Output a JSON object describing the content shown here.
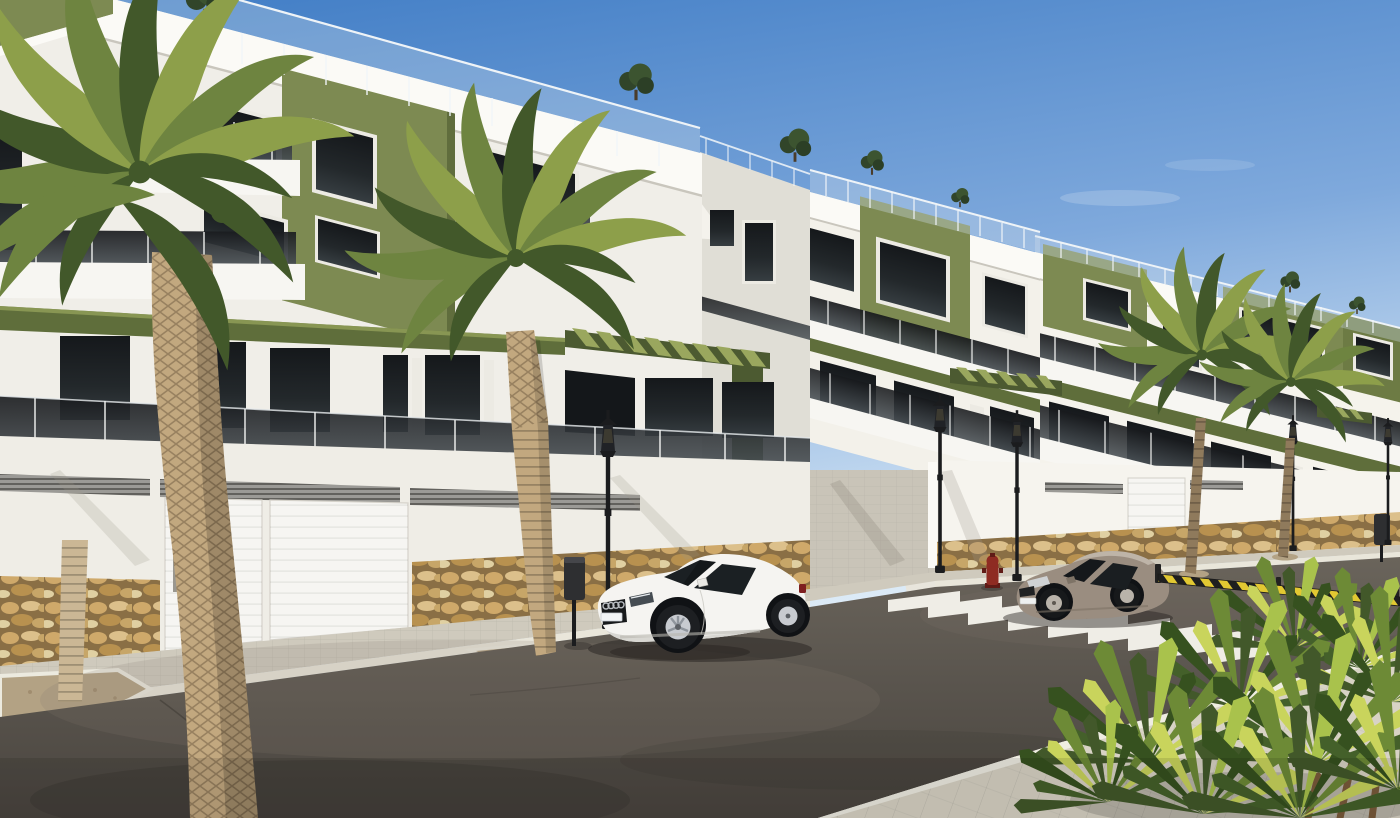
{
  "title": "Street-level architectural render of a modern white apartment development",
  "palette": {
    "skyTop": "#3f7cc5",
    "skyMid": "#7fa9dc",
    "skyHorizon": "#d9e9f6",
    "facadeA": "#f0eee8",
    "facadeB": "#f3f1ea",
    "facadeC": "#f5f3ec",
    "fasciaBright": "#fbfaf6",
    "facadeShade": "#e0ded6",
    "wallLeft": "#efede6",
    "wallRight": "#f6f4ee",
    "oliveLit": "#7d8a52",
    "oliveMid": "#6d7b44",
    "oliveDark": "#4c5a31",
    "oliveBand": "#5f6e3b",
    "slatLit": "#9aa75e",
    "glassDark": "#23282b",
    "glassDark2": "#363d41",
    "frameWhite": "#eceae3",
    "slabWhite": "#f7f6f2",
    "railGlass": "#2b3034",
    "postWhite": "#f2f4f4",
    "stoneJoint": "#8a6f45",
    "stone1": "#cfa96a",
    "stone2": "#dcc08b",
    "stone3": "#b8914f",
    "stone4": "#c7a668",
    "stone5": "#e0d0a2",
    "garageDoor": "#f6f5f2",
    "louver": "#9b9a96",
    "louverDark": "#62615d",
    "sidewalk": "#cfcabd",
    "curb": "#e9e6da",
    "plaza": "#d8d3c5",
    "gravel": "#b3a284",
    "road": "#59544d",
    "roadLight": "#847b6f",
    "roadDark": "#332f2b",
    "cw": "#f5f3ec",
    "carWhite": "#f5f4f1",
    "carWhiteShade": "#d8d7d2",
    "carGray": "#9a8d80",
    "carGrayLight": "#beb4a8",
    "carGlass": "#1b2023",
    "lampBlack": "#1b1c1e",
    "hydrant": "#8e2b22",
    "hydrantDark": "#5f1b16",
    "barrierY": "#e2c832",
    "barrierK": "#1f1f1f",
    "palmD": "#42582a",
    "palmM": "#6e8440",
    "palmL": "#8d9f4a",
    "palmY": "#c9d45c",
    "trunkLit": "#c2a87f",
    "trunkShade": "#8f7a5c",
    "trunkSlim": "#cbb795",
    "binDark": "#2e2f31",
    "shadow": "#262220"
  },
  "scene": {
    "sky": {
      "condition": "clear with faint wisps",
      "top_color": "#3f7cc5",
      "horizon_color": "#d9e9f6"
    },
    "buildings": {
      "blocks": 3,
      "style": "modern white render apartments with olive-green accent volumes",
      "floors_visible": 3,
      "features": [
        "roof terraces with glass railings",
        "tinted-glass balcony balustrades",
        "olive pergola slat awnings",
        "rubble stone base course",
        "white sectional garage doors",
        "ventilation louver bands",
        "rooftop shrubs"
      ]
    },
    "street": {
      "road_color": "#59544d",
      "crosswalk_stripe_count": 9,
      "crosswalk_color": "#f5f3ec",
      "sidewalk_color": "#cfcabd",
      "corner_plaza_color": "#d8d3c5",
      "hazard_barrier_colors": [
        "#e2c832",
        "#1f1f1f"
      ]
    },
    "vehicles": [
      {
        "type": "coupe",
        "description": "white sports coupe parked at left curb",
        "color": "#f5f4f1"
      },
      {
        "type": "coupe",
        "description": "warm-gray coupe parked at right curb",
        "color": "#9a8d80"
      }
    ],
    "vegetation": {
      "street_palm_trees": 4,
      "foreground_fan_palm_cluster": 1,
      "rooftop_trees": 4,
      "balcony_plants": 3
    },
    "street_furniture": {
      "classic_lantern_street_lamps": 5,
      "litter_bins": 2,
      "fire_hydrant_color": "#8e2b22"
    }
  }
}
